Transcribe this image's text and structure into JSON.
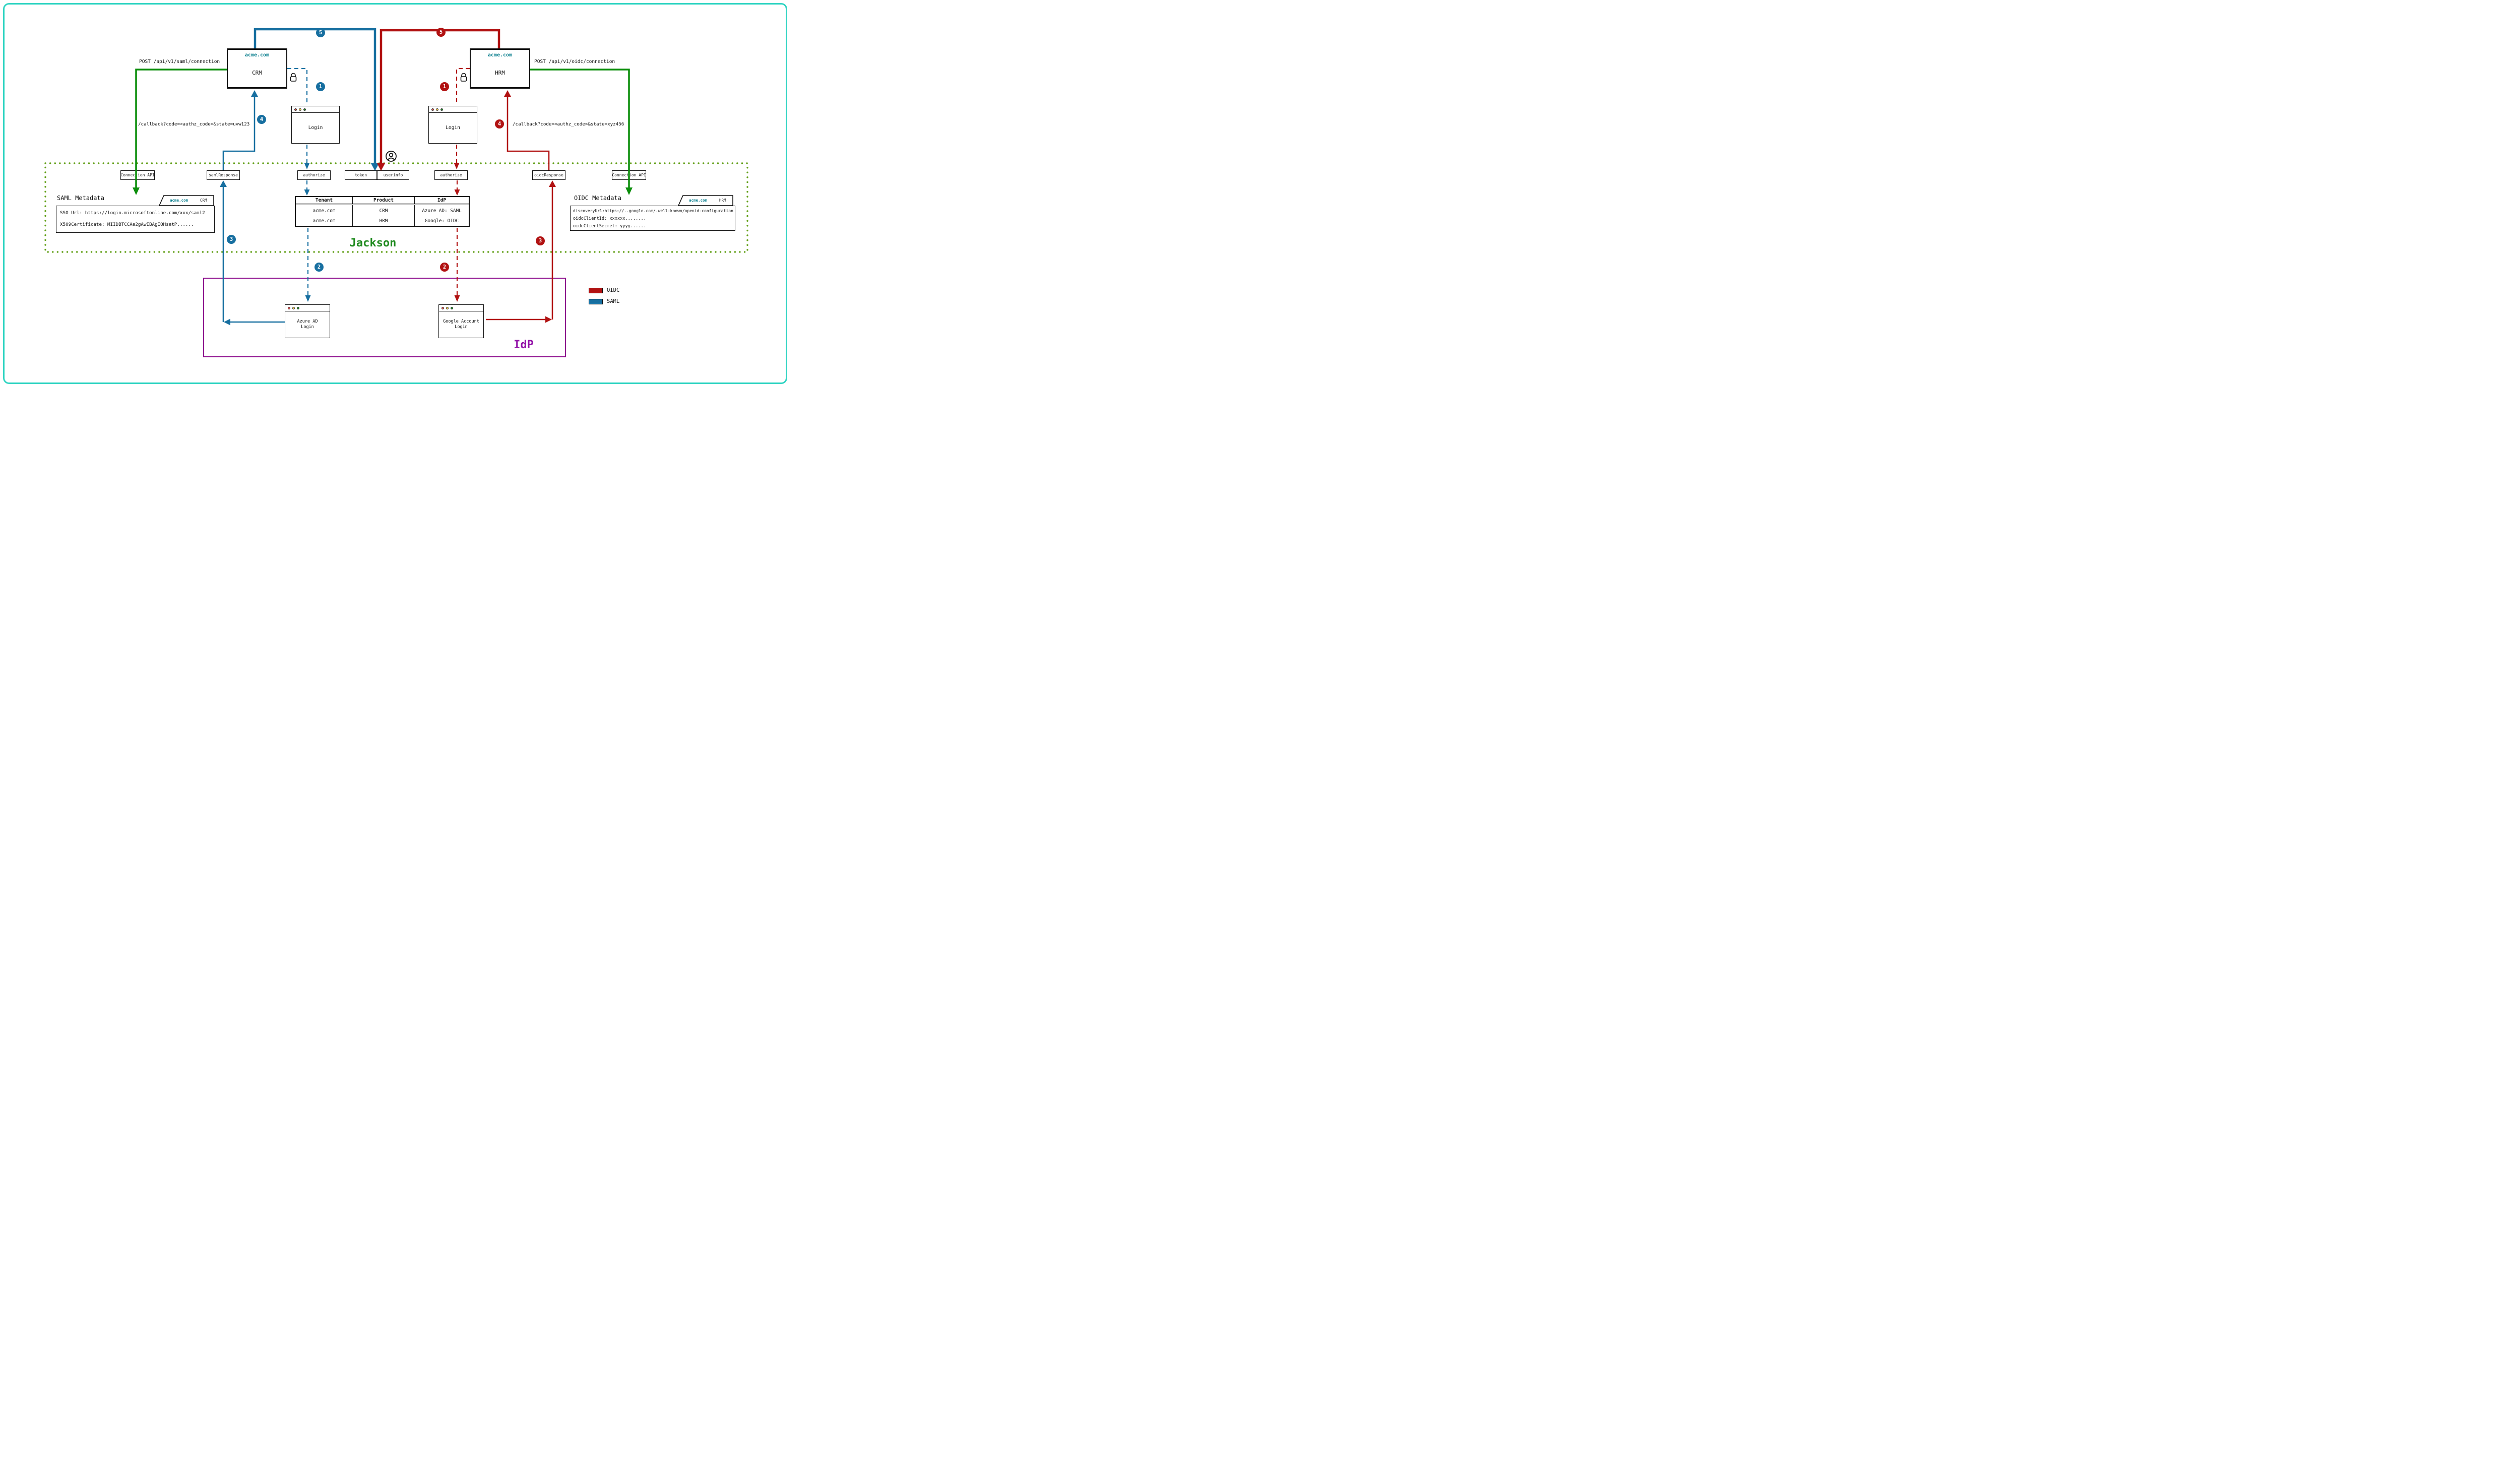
{
  "apps": {
    "crm": {
      "domain": "acme.com",
      "name": "CRM",
      "api_call": "POST /api/v1/saml/connection",
      "callback": "/callback?code=<authz_code>&state=uvw123",
      "login_window": "Login"
    },
    "hrm": {
      "domain": "acme.com",
      "name": "HRM",
      "api_call": "POST /api/v1/oidc/connection",
      "callback": "/callback?code=<authz_code>&state=xyz456",
      "login_window": "Login"
    }
  },
  "jackson": {
    "label": "Jackson",
    "endpoints": [
      "Connection API",
      "samlResponse",
      "authorize",
      "token",
      "userinfo",
      "authorize",
      "oidcResponse",
      "Connection API"
    ],
    "saml_metadata": {
      "title": "SAML Metadata",
      "tab_domain": "acme.com",
      "tab_app": "CRM",
      "lines": [
        "SSO Url: https://login.microsoftonline.com/xxx/saml2",
        "X509Certificate: MIIDBTCCAe2gAwIBAgIQHsetP......"
      ]
    },
    "oidc_metadata": {
      "title": "OIDC Metadata",
      "tab_domain": "acme.com",
      "tab_app": "HRM",
      "lines": [
        "discoveryUrl:https://..google.com/.well-known/openid-configuration",
        "oidcClientId: xxxxxx........",
        "oidcClientSecret: yyyy......"
      ]
    },
    "connections_table": {
      "headers": [
        "Tenant",
        "Product",
        "IdP"
      ],
      "rows": [
        [
          "acme.com",
          "CRM",
          "Azure AD: SAML"
        ],
        [
          "acme.com",
          "HRM",
          "Google: OIDC"
        ]
      ]
    }
  },
  "idp": {
    "label": "IdP",
    "azure_window": [
      "Azure AD",
      "Login"
    ],
    "google_window": [
      "Google Account",
      "Login"
    ]
  },
  "step_numbers": [
    "1",
    "2",
    "3",
    "4",
    "5"
  ],
  "legend": {
    "items": [
      {
        "label": "OIDC",
        "color": "#b11212"
      },
      {
        "label": "SAML",
        "color": "#176fa0"
      }
    ]
  },
  "colors": {
    "saml_flow": "#176fa0",
    "oidc_flow": "#b11212",
    "connection_api_flow": "#0b8e0b",
    "jackson_border": "#63a019",
    "jackson_label": "#1e8a1e",
    "idp_border": "#8e0e8e",
    "idp_label": "#9314a8",
    "domain_text": "#0c808f",
    "frame_accent": "#2fd4c2"
  }
}
